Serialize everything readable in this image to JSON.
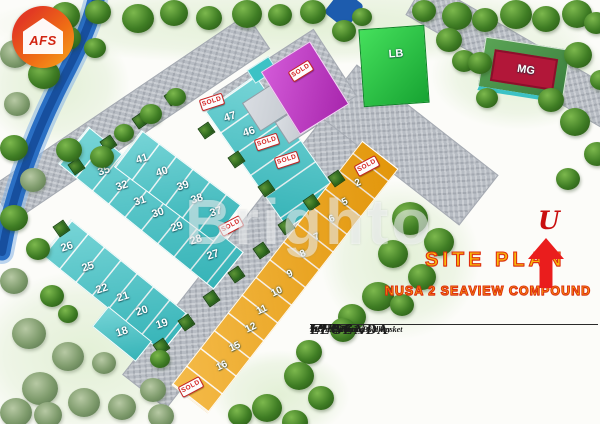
{
  "branding": {
    "logo_text": "AFS"
  },
  "titles": {
    "site_plan": "SITE PLAN",
    "project": "NUSA 2 SEAVIEW COMPOUND",
    "north_label": "U"
  },
  "watermark": "Brighto",
  "legend": {
    "title": "LEGENDA",
    "columns": [
      [
        "K. 01 105 m2",
        "K. 02 105 m2",
        "K. 05 105 m2",
        "K. 06 105 m2",
        "K. 07 105 m2",
        "K. 08 104 m2",
        "K. 09 104 m2",
        "K. 10 104 m2"
      ],
      [
        "K. 11 104 m2",
        "K. 12 105 m2",
        "K. 15 102 m2",
        "K. 16 102 m2",
        "K. 17 191 m2",
        "K. 18 164 m2",
        "K. 19 105 m2",
        "K. 20 105 m2"
      ],
      [
        "K. 21 104 m2",
        "K. 22 132 m2",
        "K. 25 118 m2",
        "K. 26 113 m2",
        "K. 27 105 m2",
        "K. 28 105 m2",
        "K. 29 105 m2",
        "K. 30 105 m2"
      ],
      [
        "K. 31 105 m2",
        "K. 32 105 m2",
        "K. 35 117 m2",
        "K. 36 105 m2",
        "K. 37 105 m2",
        "K. 38 105 m2",
        "K. 39 105 m2",
        "K. 40 105 m2"
      ],
      [
        "K. 41 105 m2",
        "K. 42 112 m2",
        "K. 45 112 m2",
        "K. 46 112 m2",
        "K. 47 112 m2",
        "K. 48 112 m2",
        "K. 49 ..... m2"
      ]
    ],
    "footnotes": [
      "MG : Marketing Gallery",
      "P : Pos Security",
      "LB : Lapangan Bola Basket"
    ]
  },
  "map": {
    "colors": {
      "teal_lot": "#3cc2c5",
      "orange_lot": "#f1a40c",
      "lb_green": "#2fd04a",
      "mg_red": "#b21739",
      "security_magenta": "#c94fd0",
      "road_gray": "#b7bcc3",
      "river_blue": "#2a6fc4",
      "sold_red": "#d41f1f",
      "title_gold": "#f8b90b",
      "title_red_outline": "#df2f10"
    },
    "area_labels": [
      {
        "text": "LB",
        "x": 396,
        "y": 54,
        "r": -4
      },
      {
        "text": "MG",
        "x": 526,
        "y": 70,
        "r": 9
      }
    ],
    "sold_text": "SOLD",
    "teal_lots": [
      {
        "n": "47",
        "x": 230,
        "y": 117
      },
      {
        "n": "46",
        "x": 249,
        "y": 132
      },
      {
        "n": "41",
        "x": 142,
        "y": 159
      },
      {
        "n": "40",
        "x": 162,
        "y": 172
      },
      {
        "n": "39",
        "x": 183,
        "y": 186
      },
      {
        "n": "38",
        "x": 197,
        "y": 199
      },
      {
        "n": "37",
        "x": 216,
        "y": 212
      },
      {
        "n": "35",
        "x": 104,
        "y": 171
      },
      {
        "n": "32",
        "x": 122,
        "y": 186
      },
      {
        "n": "31",
        "x": 140,
        "y": 201
      },
      {
        "n": "30",
        "x": 158,
        "y": 213
      },
      {
        "n": "29",
        "x": 177,
        "y": 227
      },
      {
        "n": "28",
        "x": 196,
        "y": 240
      },
      {
        "n": "27",
        "x": 213,
        "y": 255
      },
      {
        "n": "26",
        "x": 67,
        "y": 247
      },
      {
        "n": "25",
        "x": 88,
        "y": 267
      },
      {
        "n": "22",
        "x": 102,
        "y": 289
      },
      {
        "n": "21",
        "x": 123,
        "y": 297
      },
      {
        "n": "20",
        "x": 142,
        "y": 311
      },
      {
        "n": "19",
        "x": 162,
        "y": 324
      },
      {
        "n": "18",
        "x": 122,
        "y": 332
      }
    ],
    "orange_lots": [
      {
        "n": "2",
        "x": 358,
        "y": 183
      },
      {
        "n": "5",
        "x": 345,
        "y": 202
      },
      {
        "n": "6",
        "x": 332,
        "y": 219
      },
      {
        "n": "7",
        "x": 317,
        "y": 237
      },
      {
        "n": "8",
        "x": 303,
        "y": 254
      },
      {
        "n": "9",
        "x": 290,
        "y": 274
      },
      {
        "n": "10",
        "x": 277,
        "y": 292
      },
      {
        "n": "11",
        "x": 262,
        "y": 310
      },
      {
        "n": "12",
        "x": 251,
        "y": 328
      },
      {
        "n": "15",
        "x": 235,
        "y": 347
      },
      {
        "n": "16",
        "x": 222,
        "y": 366
      }
    ],
    "sold_signs": [
      {
        "x": 212,
        "y": 102,
        "r": -18
      },
      {
        "x": 267,
        "y": 142,
        "r": -18
      },
      {
        "x": 287,
        "y": 160,
        "r": -18
      },
      {
        "x": 231,
        "y": 226,
        "r": -28
      },
      {
        "x": 367,
        "y": 166,
        "r": -28
      },
      {
        "x": 191,
        "y": 387,
        "r": -28
      },
      {
        "x": 301,
        "y": 71,
        "r": -32
      }
    ],
    "planters": [
      [
        70,
        160
      ],
      [
        102,
        137
      ],
      [
        134,
        114
      ],
      [
        166,
        91
      ],
      [
        200,
        124
      ],
      [
        230,
        153
      ],
      [
        260,
        182
      ],
      [
        330,
        172
      ],
      [
        305,
        196
      ],
      [
        280,
        220
      ],
      [
        255,
        244
      ],
      [
        230,
        268
      ],
      [
        205,
        292
      ],
      [
        180,
        316
      ],
      [
        155,
        340
      ],
      [
        55,
        222
      ]
    ],
    "trees": [
      [
        50,
        2,
        30,
        "g"
      ],
      [
        85,
        0,
        26,
        "g"
      ],
      [
        122,
        4,
        32,
        "g"
      ],
      [
        160,
        0,
        28,
        "g"
      ],
      [
        196,
        6,
        26,
        "g"
      ],
      [
        232,
        0,
        30,
        "g"
      ],
      [
        268,
        4,
        24,
        "g"
      ],
      [
        300,
        0,
        26,
        "g"
      ],
      [
        412,
        0,
        24,
        "g"
      ],
      [
        442,
        2,
        30,
        "g"
      ],
      [
        472,
        8,
        26,
        "g"
      ],
      [
        500,
        0,
        32,
        "g"
      ],
      [
        532,
        6,
        28,
        "g"
      ],
      [
        562,
        0,
        30,
        "g"
      ],
      [
        584,
        12,
        24,
        "g"
      ],
      [
        0,
        40,
        30,
        "p"
      ],
      [
        28,
        60,
        32,
        "g"
      ],
      [
        4,
        92,
        26,
        "p"
      ],
      [
        55,
        26,
        26,
        "g"
      ],
      [
        84,
        38,
        22,
        "g"
      ],
      [
        0,
        135,
        28,
        "g"
      ],
      [
        20,
        168,
        26,
        "p"
      ],
      [
        0,
        205,
        28,
        "g"
      ],
      [
        26,
        238,
        24,
        "g"
      ],
      [
        0,
        268,
        28,
        "p"
      ],
      [
        56,
        138,
        26,
        "g"
      ],
      [
        90,
        146,
        24,
        "g"
      ],
      [
        114,
        124,
        20,
        "g"
      ],
      [
        140,
        104,
        22,
        "g"
      ],
      [
        166,
        88,
        20,
        "g"
      ],
      [
        40,
        285,
        24,
        "g"
      ],
      [
        58,
        305,
        20,
        "g"
      ],
      [
        332,
        20,
        24,
        "g"
      ],
      [
        352,
        8,
        20,
        "g"
      ],
      [
        436,
        28,
        26,
        "g"
      ],
      [
        452,
        50,
        24,
        "g"
      ],
      [
        468,
        52,
        24,
        "g"
      ],
      [
        564,
        42,
        28,
        "g"
      ],
      [
        538,
        88,
        26,
        "g"
      ],
      [
        476,
        88,
        22,
        "g"
      ],
      [
        590,
        70,
        22,
        "g"
      ],
      [
        560,
        108,
        30,
        "g"
      ],
      [
        584,
        142,
        26,
        "g"
      ],
      [
        556,
        168,
        24,
        "g"
      ],
      [
        392,
        202,
        36,
        "g"
      ],
      [
        424,
        228,
        30,
        "g"
      ],
      [
        378,
        240,
        30,
        "g"
      ],
      [
        408,
        264,
        28,
        "g"
      ],
      [
        362,
        282,
        32,
        "g"
      ],
      [
        338,
        304,
        28,
        "g"
      ],
      [
        390,
        294,
        24,
        "g"
      ],
      [
        330,
        318,
        26,
        "g"
      ],
      [
        296,
        340,
        26,
        "g"
      ],
      [
        284,
        362,
        30,
        "g"
      ],
      [
        308,
        386,
        26,
        "g"
      ],
      [
        252,
        394,
        30,
        "g"
      ],
      [
        282,
        410,
        26,
        "g"
      ],
      [
        228,
        404,
        24,
        "g"
      ],
      [
        150,
        350,
        20,
        "g"
      ],
      [
        12,
        318,
        34,
        "p"
      ],
      [
        52,
        342,
        32,
        "p"
      ],
      [
        22,
        372,
        36,
        "p"
      ],
      [
        68,
        388,
        32,
        "p"
      ],
      [
        108,
        394,
        28,
        "p"
      ],
      [
        140,
        378,
        26,
        "p"
      ],
      [
        92,
        352,
        24,
        "p"
      ],
      [
        0,
        398,
        32,
        "p"
      ],
      [
        148,
        404,
        26,
        "p"
      ],
      [
        34,
        402,
        28,
        "p"
      ]
    ]
  }
}
